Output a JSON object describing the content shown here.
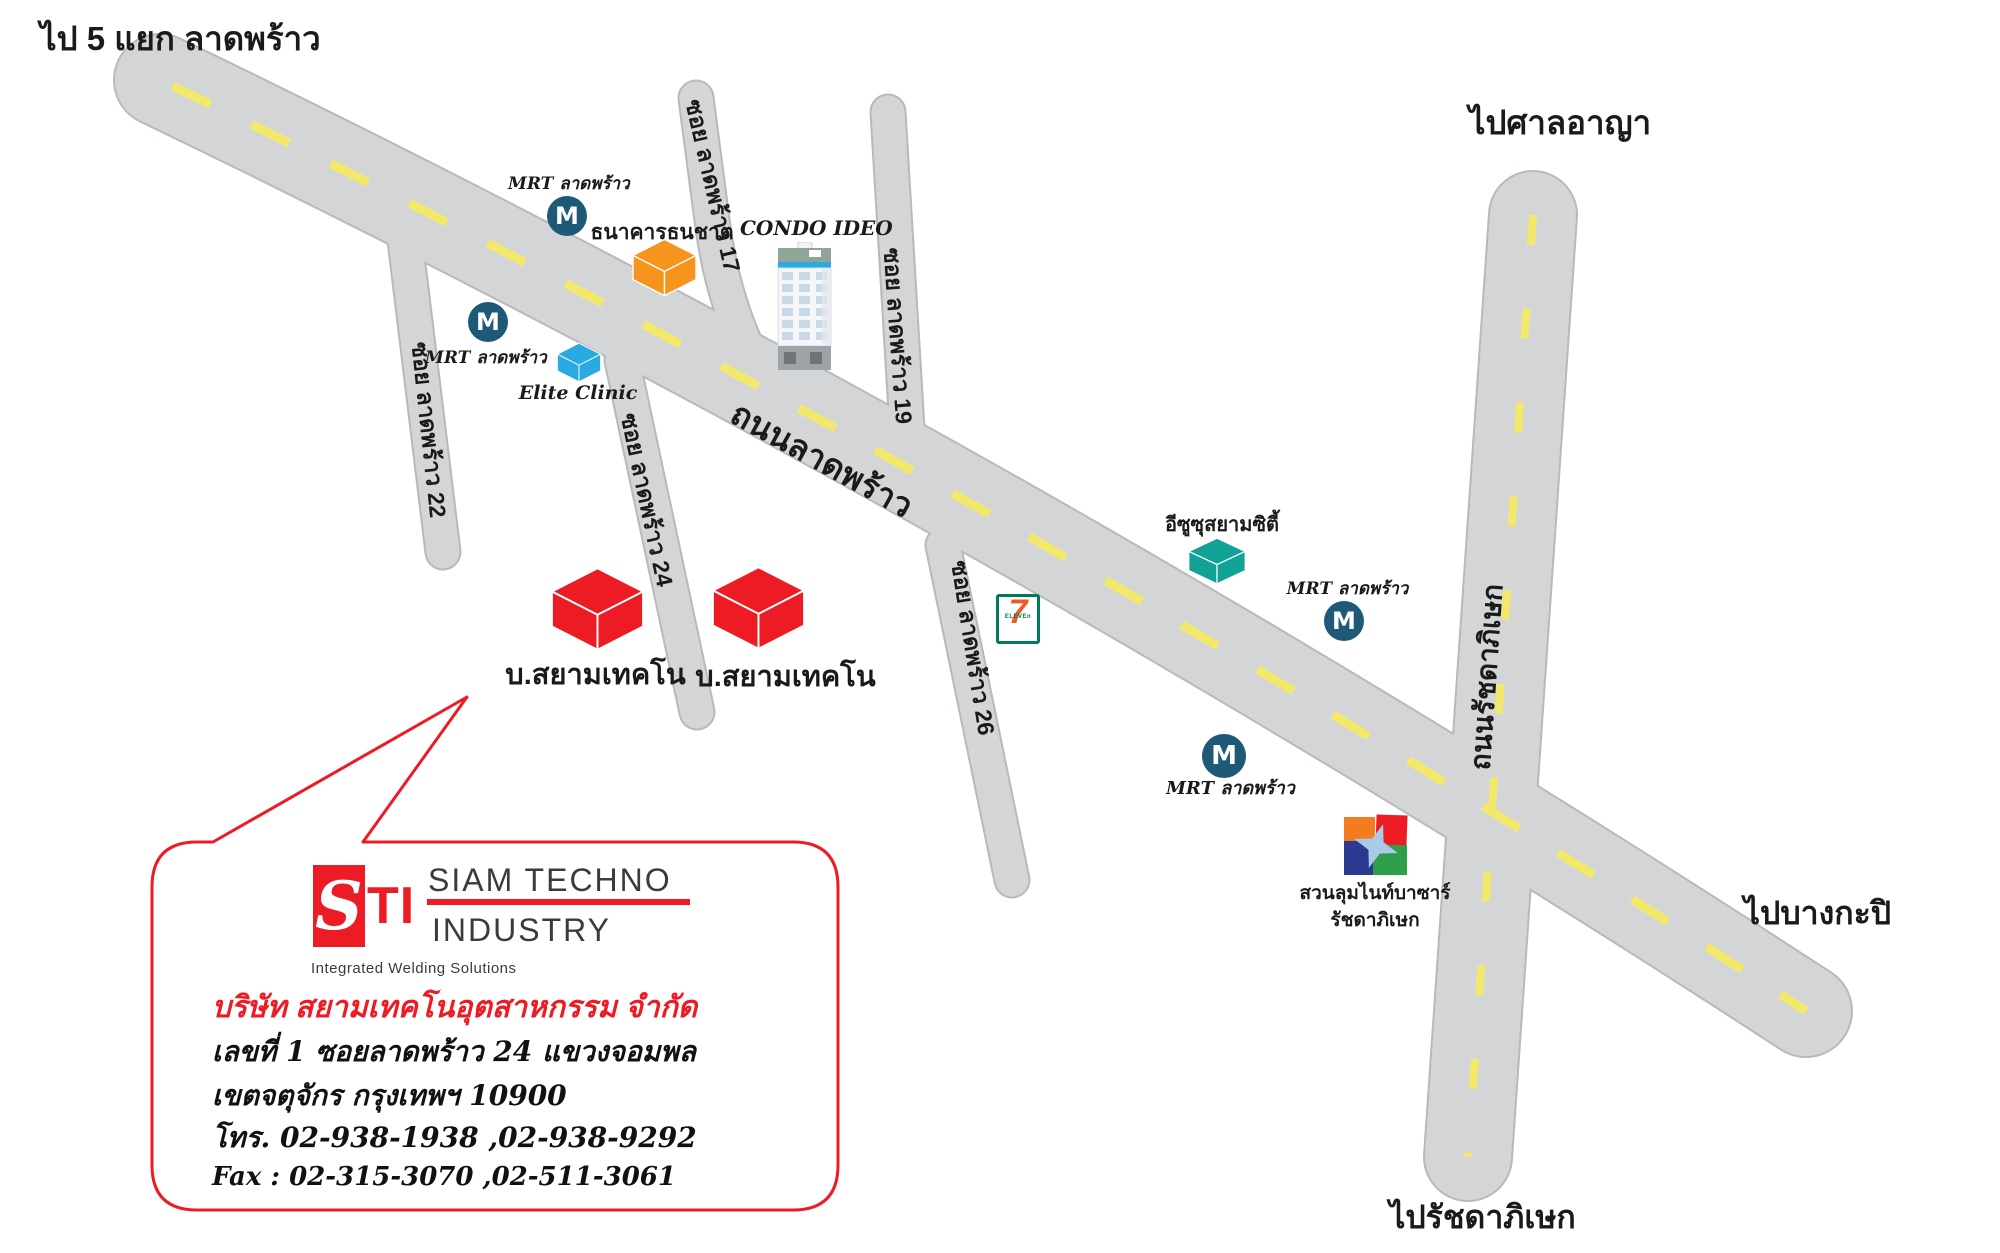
{
  "title": "ไป 5 แยก ลาดพร้าว",
  "directions": {
    "court": "ไปศาลอาญา",
    "bangkapi": "ไปบางกะปิ",
    "ratchada": "ไปรัชดาภิเษก"
  },
  "roads": {
    "main_label": "ถนนลาดพร้าว",
    "vertical_label": "ถนนรัชดาภิเษก",
    "sois": [
      "ซอย ลาดพร้าว 17",
      "ซอย ลาดพร้าว 19",
      "ซอย ลาดพร้าว 22",
      "ซอย ลาดพร้าว 24",
      "ซอย ลาดพร้าว 26"
    ]
  },
  "mrt": {
    "label": "MRT ลาดพร้าว",
    "letter": "M",
    "color": "#1e5a78"
  },
  "landmarks": {
    "bank": {
      "label": "ธนาคารธนชาต",
      "color": "#F7941E"
    },
    "condo": {
      "label": "CONDO IDEO"
    },
    "clinic": {
      "label": "Elite Clinic",
      "color": "#29ABE2"
    },
    "isuzu": {
      "label": "อีซูซุสยามซิตี้",
      "color": "#10A294"
    },
    "seven_eleven": {
      "seven": "7",
      "eleven": "ELEVEn"
    },
    "night_bazaar": {
      "line1": "สวนลุมไนท์บาซาร์",
      "line2": "รัชดาภิเษก"
    },
    "company_building": {
      "label": "บ.สยามเทคโน",
      "color": "#ED1C24"
    }
  },
  "info_box": {
    "logo": {
      "s": "S",
      "ti": "TI",
      "line1": "SIAM TECHNO",
      "line2": "INDUSTRY",
      "tagline": "Integrated Welding Solutions",
      "accent": "#ED1C24"
    },
    "company_name": "บริษัท สยามเทคโนอุตสาหกรรม จำกัด",
    "address_line1": "เลขที่ 1  ซอยลาดพร้าว 24  แขวงจอมพล",
    "address_line2": "เขตจตุจักร  กรุงเทพฯ  10900",
    "phone": "โทร. 02-938-1938 ,02-938-9292",
    "fax": "Fax : 02-315-3070 ,02-511-3061"
  },
  "colors": {
    "road_fill": "#d4d5d7",
    "road_casing": "#b7b9bb",
    "dash_yellow": "#f2e96b",
    "accent_red": "#ED1C24"
  }
}
